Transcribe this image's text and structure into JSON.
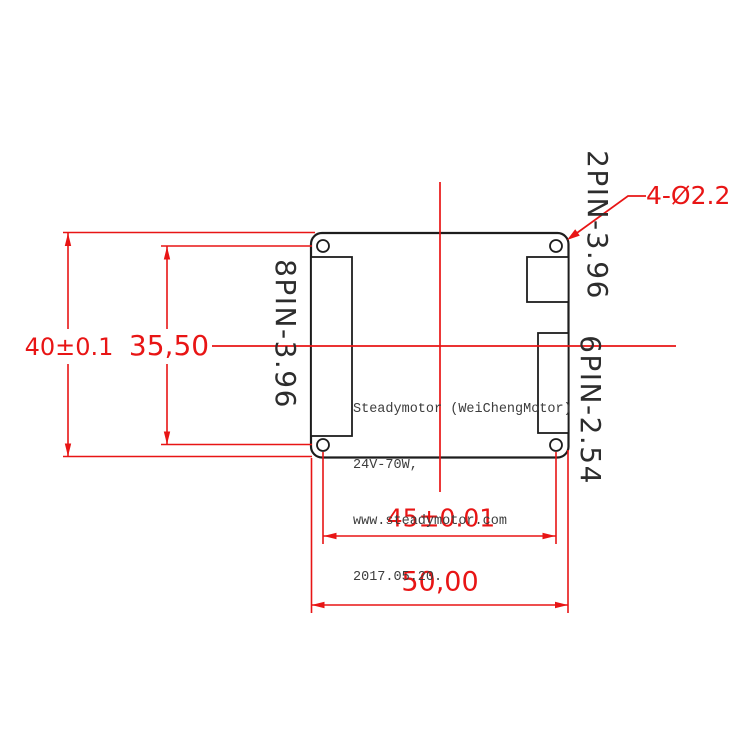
{
  "drawing": {
    "title_note": "PCB outline dimension drawing",
    "dimensions": {
      "board_height": "40±0.1",
      "hole_spacing_vertical": "35,50",
      "hole_spacing_horizontal": "45±0.01",
      "board_width": "50,00",
      "hole_callout": "4-Ø2.2"
    },
    "connectors": {
      "left": "8PIN-3.96",
      "top_right": "2PIN-3.96",
      "right": "6PIN-2.54"
    },
    "board_text": {
      "line1": "Steadymotor (WeiChengMotor)",
      "line2": "24V-70W,",
      "line3": "www.steadymotor.com",
      "line4": "2017.05.20."
    },
    "colors": {
      "dimension_red": "#e81515",
      "outline_black": "#1d1d1d",
      "note_gray": "#3d3d3d",
      "background": "#ffffff"
    }
  }
}
